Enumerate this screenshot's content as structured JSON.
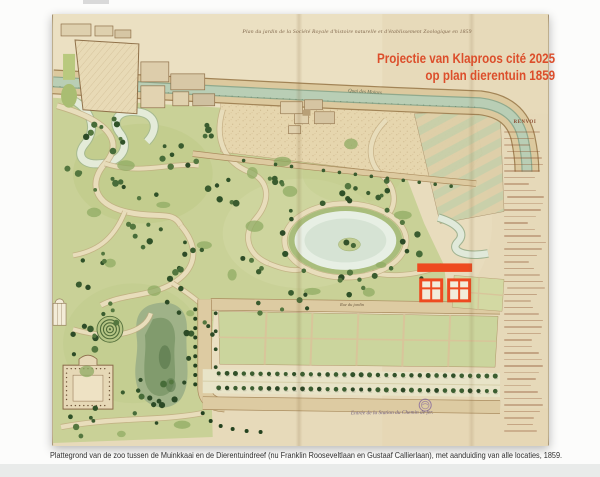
{
  "projection": {
    "line1": "Projectie van Klaproos cité 2025",
    "line2": "op plan dierentuin 1859"
  },
  "map": {
    "handwritten_title": "Plan du jardin de la Société Royale d'histoire naturelle et d'établissement Zoologique en 1859",
    "labels": {
      "quay": "Quai des Moines",
      "garden_street": "Rue du jardin",
      "station_entrance": "Entrée de la Station du Chemin de fer."
    },
    "legend": {
      "header": "RENVOI",
      "line_count": 47
    }
  },
  "caption": {
    "text": "Plattegrond van de zoo tussen de Muinkkaai en de Dierentuindreef (nu Franklin Rooseveltlaan en Gustaaf Callierlaan), met aanduiding van alle locaties, 1859."
  },
  "colors": {
    "projection_red": "#dc4e2b",
    "overlay_red": "#ee4a20",
    "paper": "#e9dec0",
    "park_green": "#c9d197",
    "canal_green": "#b9ceb5",
    "stamp_purple": "#8a6d9e"
  }
}
